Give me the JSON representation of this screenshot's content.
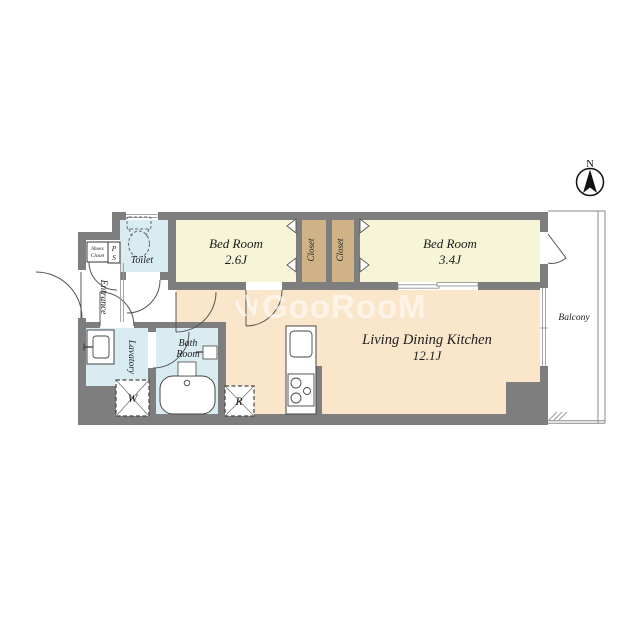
{
  "floorplan": {
    "compass": {
      "north": "N"
    },
    "watermark": "GooRooM",
    "rooms": {
      "bedroom1": {
        "name": "Bed Room",
        "size": "2.6J"
      },
      "bedroom2": {
        "name": "Bed Room",
        "size": "3.4J"
      },
      "ldk": {
        "name": "Living Dining Kitchen",
        "size": "12.1J"
      },
      "closet1": "Closet",
      "closet2": "Closet",
      "toilet": "Toilet",
      "bath": {
        "line1": "Bath",
        "line2": "Room"
      },
      "lavatory": "Lavatory",
      "entrance": "Entrance",
      "balcony": "Balcony",
      "shoes_closet": {
        "line1": "Shoes",
        "line2": "Closet"
      },
      "pipe_space": {
        "line1": "P",
        "line2": "S"
      },
      "washer_symbol": "W",
      "fridge_symbol": "R"
    },
    "colors": {
      "wall": "#7e7e7e",
      "bedroom": "#f7f5d8",
      "closet": "#cfb286",
      "ldk": "#fae6cb",
      "wet_area": "#d9ecf2",
      "balcony": "#ffffff",
      "label_text": "#1c1c1c",
      "watermark": "rgba(255,255,255,0.55)"
    }
  }
}
